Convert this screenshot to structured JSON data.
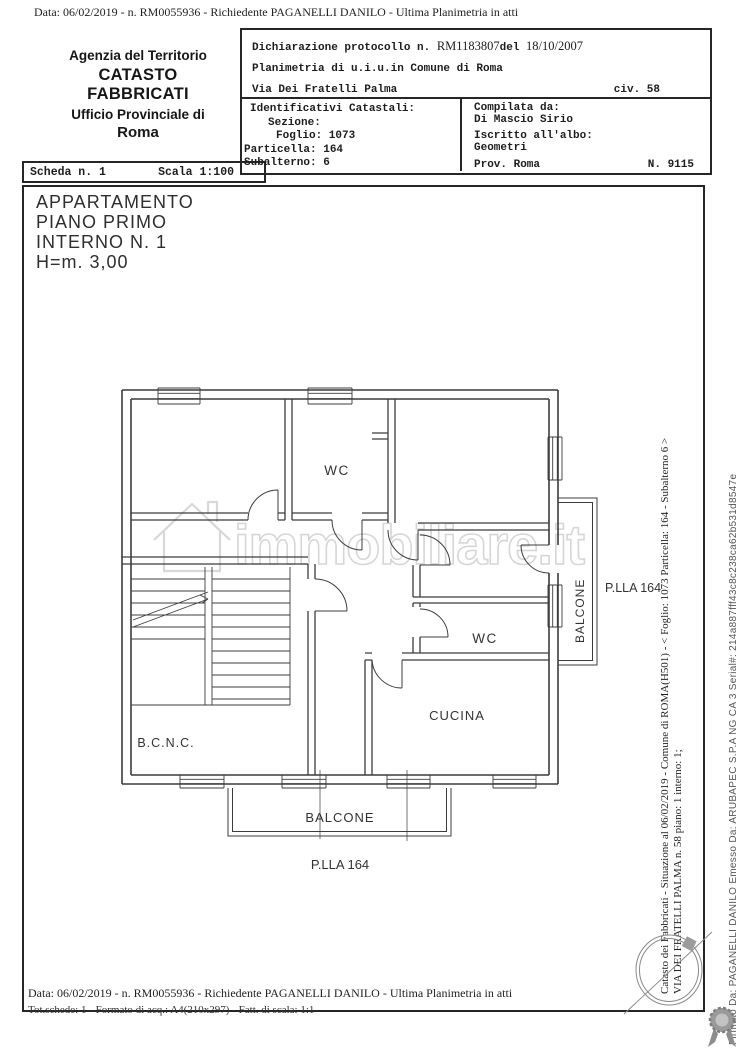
{
  "page": {
    "header_line": "Data: 06/02/2019 -  n. RM0055936 - Richiedente PAGANELLI DANILO - Ultima Planimetria in atti",
    "footer_line1": "Data: 06/02/2019 -  n. RM0055936 - Richiedente PAGANELLI DANILO - Ultima Planimetria in atti",
    "footer_line2": "Tot.schede: 1 - Formato di acq.: A4(210x297) - Fatt. di scala: 1:1"
  },
  "agency": {
    "line1": "Agenzia del Territorio",
    "line2": "CATASTO FABBRICATI",
    "line3": "Ufficio Provinciale di",
    "line4": "Roma"
  },
  "scheda": {
    "scheda": "Scheda n. 1",
    "scala": "Scala 1:100"
  },
  "declaration": {
    "protocol_label": "Dichiarazione protocollo n.",
    "protocol_number": "RM1183807",
    "del_label": "del",
    "protocol_date": "18/10/2007",
    "planimetria_line": "Planimetria di u.i.u.in Comune di Roma",
    "street": "Via Dei Fratelli Palma",
    "civ": "civ. 58",
    "identificativi": {
      "title": "Identificativi Catastali:",
      "sezione_label": "Sezione:",
      "foglio": "Foglio: 1073",
      "particella": "Particella: 164",
      "subalterno": "Subalterno: 6"
    },
    "compilata": {
      "title": "Compilata da:",
      "name": "Di Mascio Sirio",
      "albo_label": "Iscritto all'albo:",
      "albo": "Geometri",
      "prov": "Prov. Roma",
      "number": "N. 9115"
    }
  },
  "plan": {
    "title_line1": "APPARTAMENTO",
    "title_line2": "PIANO PRIMO",
    "title_line3": "INTERNO N. 1",
    "title_line4": "H=m. 3,00",
    "labels": {
      "wc_top": "WC",
      "wc_mid": "WC",
      "cucina": "CUCINA",
      "bcnc": "B.C.N.C.",
      "balcone_right": "BALCONE",
      "balcone_bottom": "BALCONE",
      "plla_right": "P.LLA 164",
      "plla_bottom": "P.LLA 164"
    }
  },
  "watermark": {
    "text": "immobiliare.it"
  },
  "margin": {
    "catasto_line1": "Catasto dei Fabbricati - Situazione al 06/02/2019 - Comune di ROMA(H501) - < Foglio: 1073 Particella: 164 - Subalterno 6 >",
    "catasto_line2": "VIA DEI FRATELLI PALMA n. 58 piano: 1 interno: 1;",
    "firmato": "Firmato Da: PAGANELLI DANILO Emesso Da: ARUBAPEC S.P.A NG CA 3 Serial#: 214a887fff43c8c238ca62b531d8547e"
  }
}
